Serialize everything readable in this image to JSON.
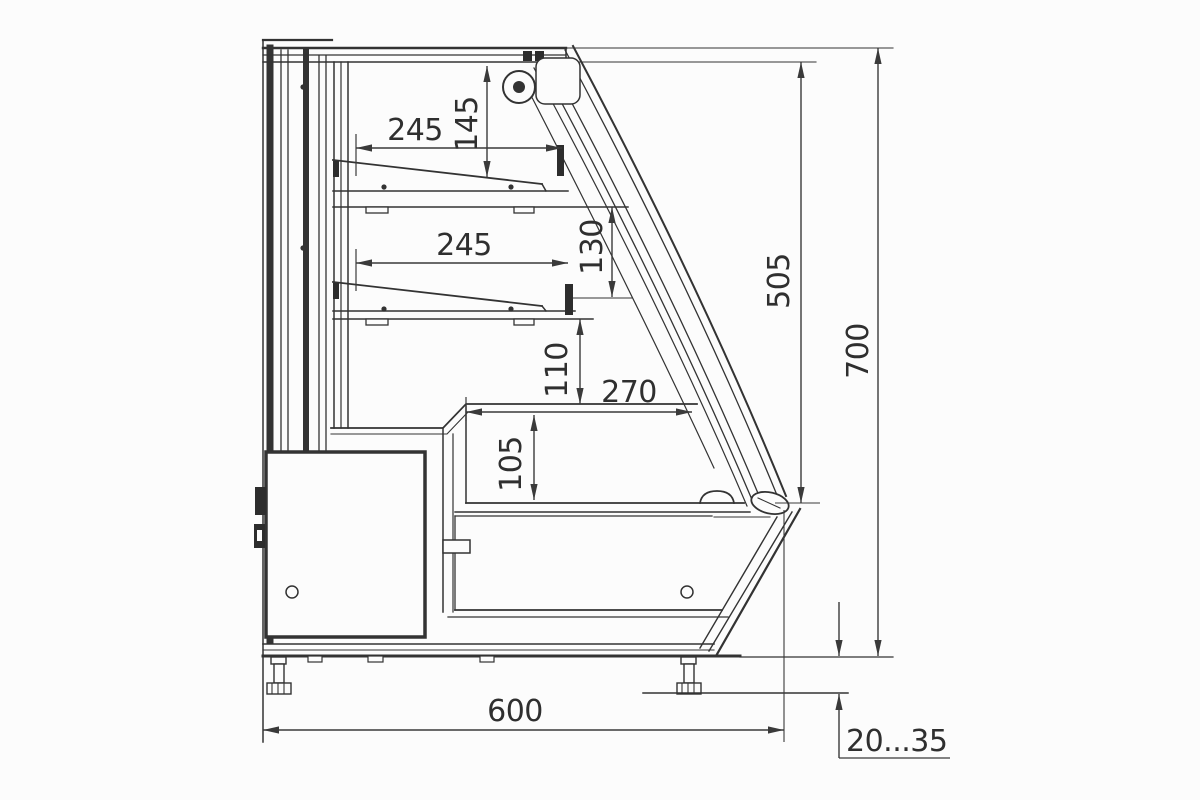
{
  "drawing": {
    "title": "display-case-side-section",
    "background": "#fcfcfc",
    "line_color": "#333333",
    "dims": {
      "shelf1_width": "245",
      "top_clearance": "145",
      "shelf2_width": "245",
      "shelf2_clearance": "130",
      "shelf_to_counter": "110",
      "well_width": "270",
      "well_depth": "105",
      "glass_front_height": "505",
      "overall_height": "700",
      "overall_depth": "600",
      "leg_height_range": "20...35"
    }
  }
}
